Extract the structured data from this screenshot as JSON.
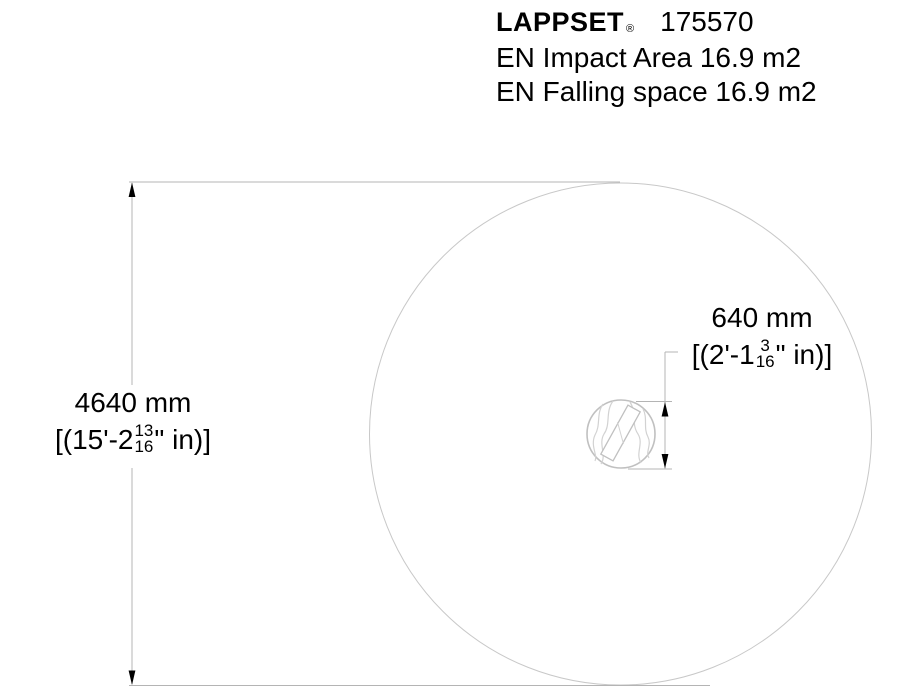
{
  "header": {
    "brand": "LAPPSET",
    "registered_mark": "®",
    "product_number": "175570",
    "impact_area_line": "EN Impact Area 16.9 m2",
    "falling_space_line": "EN Falling space 16.9 m2"
  },
  "dimensions": {
    "overall": {
      "metric": "4640 mm",
      "imperial_prefix": "[(15'-2",
      "fraction_numerator": "13",
      "fraction_denominator": "16",
      "imperial_suffix": "\" in)]"
    },
    "equipment": {
      "metric": "640 mm",
      "imperial_prefix": "[(2'-1",
      "fraction_numerator": "3",
      "fraction_denominator": "16",
      "imperial_suffix": "\" in)]"
    }
  },
  "drawing": {
    "impact_area_diameter_mm": 4640,
    "equipment_diameter_mm": 640,
    "impact_area_sqm": "16.9 m2",
    "falling_space_sqm": "16.9 m2",
    "colors": {
      "dimension_line": "#b4b4b4",
      "circle_outline": "#c8c8c8",
      "wood_texture": "#d2d2d2",
      "arrowhead": "#000000",
      "text": "#000000"
    }
  }
}
